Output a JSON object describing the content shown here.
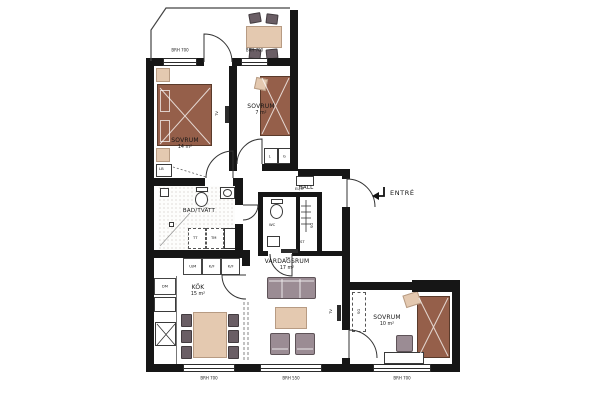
{
  "rooms": {
    "bedroom1": {
      "name": "SOVRUM",
      "area": "14 m²"
    },
    "bedroom2": {
      "name": "SOVRUM",
      "area": "7 m²"
    },
    "bedroom3": {
      "name": "SOVRUM",
      "area": "10 m²"
    },
    "bath": {
      "name": "BAD/TVÄTT"
    },
    "hall": {
      "name": "HALL"
    },
    "wc": {
      "name": "WC"
    },
    "kitchen": {
      "name": "KÖK",
      "area": "15 m²"
    },
    "living": {
      "name": "VARDAGSRUM",
      "area": "17 m²"
    }
  },
  "entry": {
    "label": "ENTRÉ"
  },
  "windows": {
    "top_left": "BRH 700",
    "top_right": "BRH 700",
    "bottom_kitchen": "BRH 700",
    "bottom_living": "BRH 550",
    "bottom_bedroom3": "BRH 700"
  },
  "appliances": {
    "dishwasher": "DM",
    "oven_microwave": "U/M",
    "fridge_freezer_1": "K/F",
    "fridge_freezer_2": "K/F",
    "dryer": "TT",
    "washer": "TM"
  },
  "closets": {
    "linen": "L",
    "wardrobe": "G",
    "linen_cabinet": "LB",
    "sliding_wardrobe_hall": "SG",
    "cleaning": "ST",
    "sliding_wardrobe_bedroom3": "SG",
    "electrical": "EL/IT"
  },
  "tv": "TV",
  "colors": {
    "wall": "#161616",
    "bed_brown": "#955f4a",
    "bed_outline": "#5a3a2a",
    "wood_beige": "#e4c9b0",
    "wood_outline": "#b79b83",
    "upholstery": "#9b8c94",
    "upholstery_outline": "#5e5358",
    "upholstery_dark": "#6a5e65",
    "tile_dot": "#c5beb8"
  }
}
